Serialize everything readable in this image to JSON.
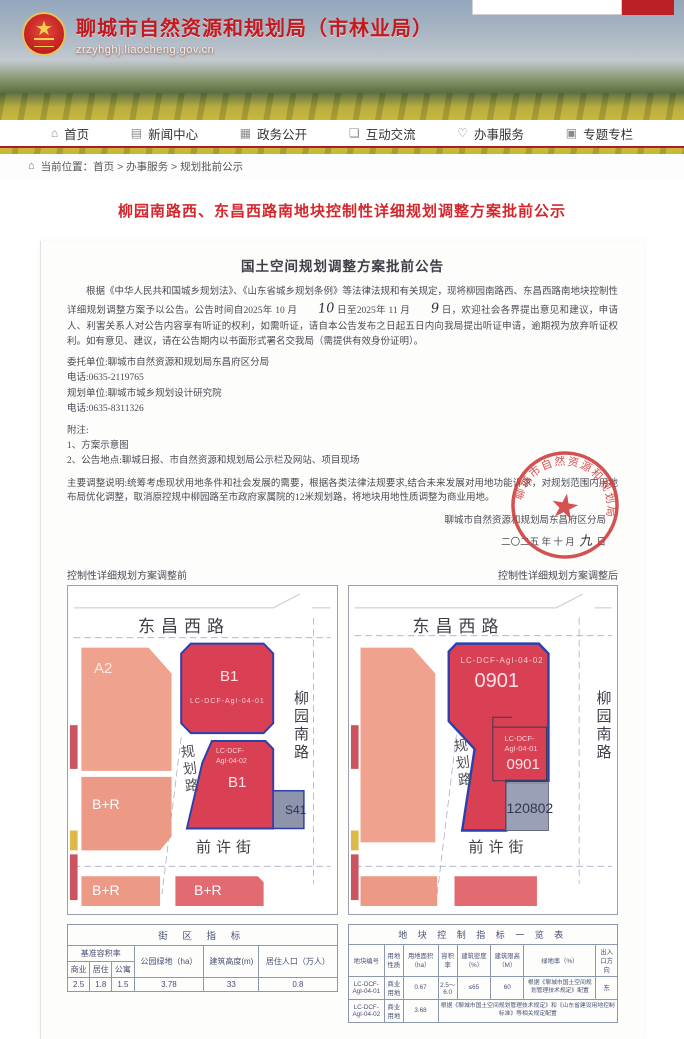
{
  "accent_colors": {
    "brand_red": "#c41a1f",
    "title_red": "#d5282e",
    "map_red": "#da4054",
    "map_salmon": "#efa28e",
    "map_gray": "#9aa0b5",
    "outline_blue": "#2b3fae",
    "stamp_red": "#cf3a3a"
  },
  "site": {
    "name": "聊城市自然资源和规划局（市林业局）",
    "url": "zrzyhghj.liaocheng.gov.cn",
    "emblem_star": "★"
  },
  "nav": {
    "items": [
      {
        "label": "首页",
        "icon": "⌂"
      },
      {
        "label": "新闻中心",
        "icon": "▤"
      },
      {
        "label": "政务公开",
        "icon": "▦"
      },
      {
        "label": "互动交流",
        "icon": "❏"
      },
      {
        "label": "办事服务",
        "icon": "♡"
      },
      {
        "label": "专题专栏",
        "icon": "▣"
      }
    ]
  },
  "breadcrumb": {
    "icon": "⌂",
    "prefix": "当前位置：",
    "path": "首页 > 办事服务 > 规划批前公示"
  },
  "article": {
    "title": "柳园南路西、东昌西路南地块控制性详细规划调整方案批前公示"
  },
  "notice": {
    "title": "国土空间规划调整方案批前公告",
    "para1_a": "根据《中华人民共和国城乡规划法》、《山东省城乡规划条例》等法律法规和有关规定，现将柳园南路西、东昌西路南地块控制性详细规划调整方案予以公告。公告时间自2025年 10 月",
    "hand_day1": "10",
    "para1_b": "日至2025年 11 月",
    "hand_day2": "9",
    "para1_c": "日，欢迎社会各界提出意见和建议，申请人、利害关系人对公告内容享有听证的权利，如需听证，请自本公告发布之日起五日内向我局提出听证申请，逾期视为放弃听证权利。如有意见、建议，请在公告期内以书面形式署名交我局（需提供有效身份证明）。",
    "entrust_unit": "委托单位:聊城市自然资源和规划局东昌府区分局",
    "phone1": "电话:0635-2119765",
    "plan_unit": "规划单位:聊城市城乡规划设计研究院",
    "phone2": "电话:0635-8311326",
    "notes_title": "附注:",
    "note1": "1、方案示意图",
    "note2": "2、公告地点:聊城日报、市自然资源和规划局公示栏及网站、项目现场",
    "adjustment": "主要调整说明:统筹考虑现状用地条件和社会发展的需要，根据各类法律法规要求,结合未来发展对用地功能诉求，对规划范围内用地布局优化调整，取消原控规中柳园路至市政府家属院的12米规划路，将地块用地性质调整为商业用地。",
    "sign_org": "聊城市自然资源和规划局东昌府区分局",
    "sign_date_a": "二〇二五 年 十 月",
    "hand_day3": "九",
    "sign_date_b": "日",
    "stamp_text": "聊城市自然资源和规划局东昌府区分局",
    "stamp_star": "★"
  },
  "maps": {
    "before": {
      "caption": "控制性详细规划方案调整前",
      "road_top": "东昌西路",
      "road_right": "柳园南路",
      "road_mid": "规划路",
      "road_bottom": "前许街",
      "block_a2": "A2",
      "block_b1_top": "B1",
      "code_top": "LC-DCF-AgI-04-01",
      "code_bottom_1": "LC-DCF-",
      "code_bottom_2": "AgI-04-02",
      "block_b1_bottom": "B1",
      "block_s41": "S41",
      "block_br_mid": "B+R",
      "block_br_bl": "B+R",
      "block_br_bm": "B+R"
    },
    "after": {
      "caption": "控制性详细规划方案调整后",
      "road_top": "东昌西路",
      "road_right": "柳园南路",
      "road_mid": "规划路",
      "road_bottom": "前许街",
      "code_main": "LC-DCF-AgI-04-02",
      "num_main": "0901",
      "code_sub_1": "LC-DCF-",
      "code_sub_2": "AgI-04-01",
      "num_sub": "0901",
      "num_gray": "120802"
    }
  },
  "left_table": {
    "title": "街 区 指 标",
    "group_header": "基准容积率",
    "sub_headers": [
      "商业",
      "居住",
      "公寓"
    ],
    "col_park": "公园绿地（ha）",
    "col_height": "建筑高度(m)",
    "col_pop": "居住人口（万人）",
    "values": [
      "2.5",
      "1.8",
      "1.5",
      "3.78",
      "33",
      "0.8"
    ]
  },
  "right_table": {
    "title": "地 块 控 制 指 标 一 览 表",
    "headers": [
      "地块编号",
      "用地性质",
      "用地面积（ha）",
      "容积率",
      "建筑密度（%）",
      "建筑限高（M）",
      "绿地率（%）",
      "出入口方向"
    ],
    "row1": [
      "LC-DCF-AgI-04-01",
      "商业用地",
      "0.67",
      "2.5～6.0",
      "≤65",
      "60",
      "根据《聊城市国土空间规划管理技术规定》配置",
      "东"
    ],
    "row2": {
      "c0": "LC-DCF-AgI-04-02",
      "c1": "商业用地",
      "c2": "3.68",
      "merged": "根据《聊城市国土空间规划管理技术规定》和《山东省建设用地控制标准》等相关规定配置"
    }
  }
}
